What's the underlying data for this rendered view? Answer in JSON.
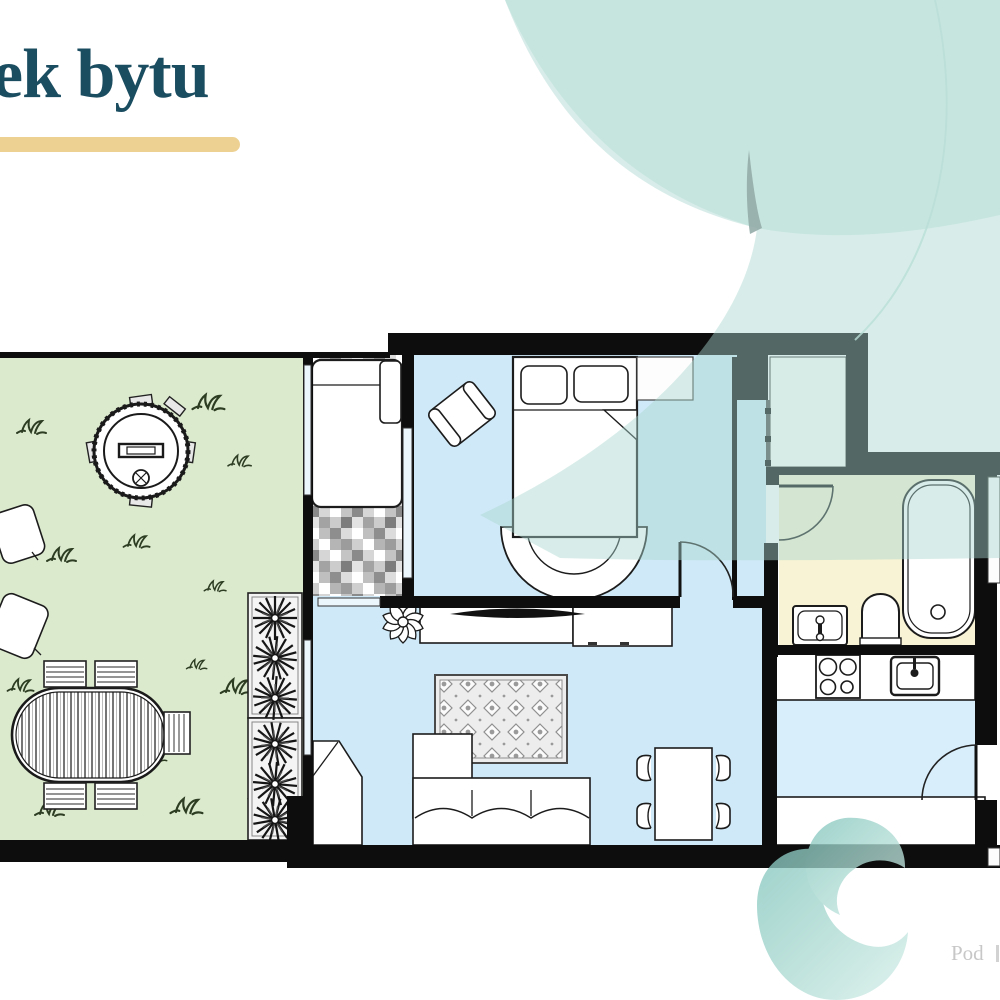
{
  "header": {
    "title": "ek bytu"
  },
  "footer": {
    "brand": "Pod"
  },
  "palette": {
    "title-color": "#1b4d61",
    "gold": "#ecd193",
    "wall": "#0d0d0d",
    "garden": "#dbe9cd",
    "grass": "#2c3d22",
    "floor-blue": "#cfe9f8",
    "floor-blue-light": "#d8eefb",
    "bath-yellow": "#f7f3d4",
    "glass": "#eaf5fc",
    "swirl-overlay": "#a9d8cf",
    "swirl-teal-dark": "#82c5bc",
    "swirl-teal-pale": "#d6efe9",
    "footer-text": "#c7c7c7"
  },
  "floorplan": {
    "rooms": [
      "garden-terrace",
      "sunroom",
      "bedroom",
      "corridor",
      "walk-in-closet",
      "bathroom",
      "kitchen-entry",
      "living-room"
    ],
    "furniture": [
      "garden-dining-table",
      "garden-chairs",
      "hot-tub",
      "garden-cushions",
      "planter-boxes",
      "daybed",
      "double-bed",
      "bedroom-armchair",
      "bedroom-rug",
      "tv-sideboard",
      "potted-plant",
      "area-rug",
      "corner-sofa",
      "corner-cabinet",
      "dining-table",
      "dining-chairs",
      "kitchen-counter",
      "stove",
      "kitchen-sink",
      "entry-counter",
      "bathtub",
      "toilet",
      "bathroom-sink"
    ]
  }
}
